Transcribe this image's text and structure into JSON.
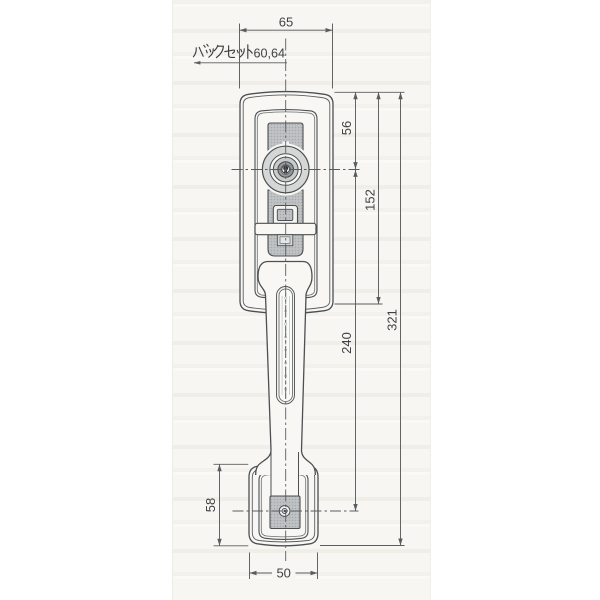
{
  "dimensions": {
    "top_width": "65",
    "backset_kana": "バックセット",
    "backset_value": "60,64",
    "backset_full": "バックセット60,64",
    "cylinder_center_from_top": "56",
    "escutcheon_height": "152",
    "grip_span": "240",
    "overall_height": "321",
    "bottom_plate_height": "58",
    "bottom_plate_width": "50"
  },
  "colors": {
    "outline": "#4c5052",
    "dim_line": "#5a5d5f",
    "halftone_gray": "#bfc3c4",
    "halftone_dot": "#a4a9ab",
    "cylinder_face": "#d5d7d6",
    "paper": "#f7f6f2"
  }
}
